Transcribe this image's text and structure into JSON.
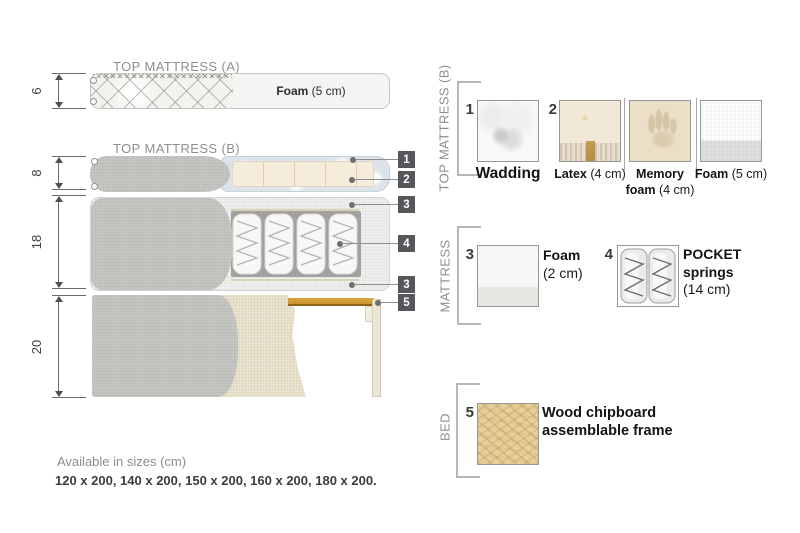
{
  "titles": {
    "top_mattress_a": "TOP MATTRESS (A)",
    "top_mattress_b": "TOP MATTRESS (B)"
  },
  "dimensions": {
    "top_a": "6",
    "top_b": "8",
    "mattress": "18",
    "bed": "20"
  },
  "diagram_labels": {
    "foam_a_name": "Foam",
    "foam_a_detail": " (5 cm)"
  },
  "callouts": {
    "c1": "1",
    "c2": "2",
    "c3a": "3",
    "c4": "4",
    "c3b": "3",
    "c5": "5"
  },
  "legend": {
    "sections": {
      "top_b": "TOP MATTRESS (B)",
      "mattress": "MATTRESS",
      "bed": "BED"
    },
    "items": {
      "wadding": {
        "num": "1",
        "name": "Wadding",
        "detail": ""
      },
      "latex": {
        "num": "2",
        "name": "Latex",
        "detail": " (4 cm)"
      },
      "memory": {
        "name": "Memory foam",
        "detail": " (4 cm)"
      },
      "foam5": {
        "name": "Foam",
        "detail": " (5 cm)"
      },
      "foam2": {
        "num": "3",
        "name": "Foam",
        "detail": "(2 cm)"
      },
      "pocket": {
        "num": "4",
        "name": "POCKET springs",
        "detail": "(14 cm)"
      },
      "chipboard": {
        "num": "5",
        "name": "Wood chipboard assemblable frame",
        "detail": ""
      }
    }
  },
  "footer": {
    "sizes_title": "Available in sizes (cm)",
    "sizes_list": "120 x 200, 140 x 200, 150 x 200, 160 x 200, 180 x 200."
  },
  "colors": {
    "wood_slat": "#c9952f",
    "callout_box": "#55575a",
    "cover_gray": "#c5c6c2",
    "foam_cream": "#f6ecdc",
    "wadding_blue": "#dde4e9",
    "bed_beige": "#e9e4d2",
    "chipboard": "#e6d09e",
    "muted_text": "#8f8f8f"
  }
}
